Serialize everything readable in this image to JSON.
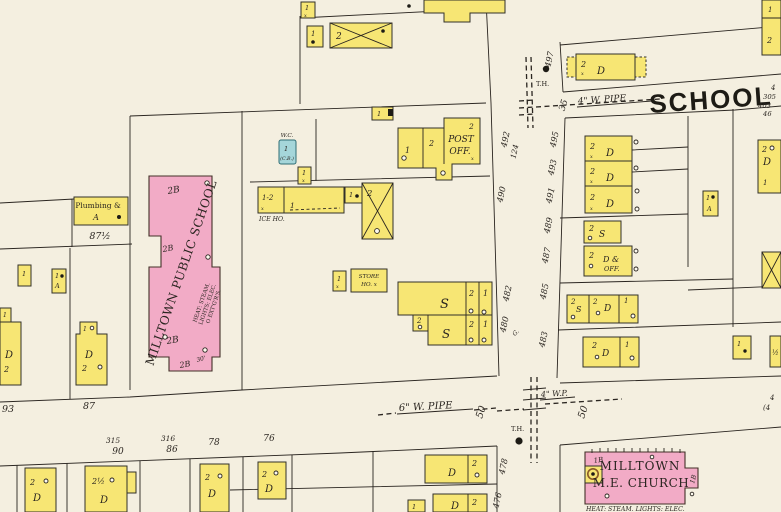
{
  "map": {
    "type": "sanborn-fire-insurance-map",
    "colors": {
      "background": "#f4efe0",
      "frame_building_yellow": "#f7e674",
      "brick_building_pink": "#f2abc6",
      "special_building_blue": "#a5d6da",
      "line_ink": "#2a2520"
    },
    "labels": {
      "plumbing1": "Plumbing &",
      "plumbing2": "A",
      "school_name": "MILLTOWN PUBLIC SCHOOL",
      "school_d1": "HEAT: STEAM.",
      "school_d2": "LIGHTS: ELEC.",
      "school_d3": "O EXT'G'R'S.",
      "wc": "W.C.",
      "cb": "(C.B.)",
      "ice": "ICE HO.",
      "store1": "STORE",
      "store2": "HO. x",
      "post1": "POST",
      "post2": "OFF.",
      "d_off1": "D &",
      "d_off2": "OFF.",
      "church1": "MILLTOWN",
      "church2": "M.E. CHURCH",
      "church_heat": "HEAT: STEAM. LIGHTS: ELEC.",
      "school_street": "SCHOOL",
      "pipe4": "4\" W. PIPE",
      "pipe6": "6\" W. PIPE",
      "pipe4b": "4\" W.P.",
      "th": "T.H."
    },
    "numbers": {
      "n497": "497",
      "n492": "492",
      "n124": "124",
      "n490": "490",
      "n482": "482",
      "n480": "480",
      "n478": "478",
      "n476": "476",
      "n495": "495",
      "n493": "493",
      "n491": "491",
      "n489": "489",
      "n487": "487",
      "n485": "485",
      "n483": "483",
      "n305": "305",
      "n403": "403",
      "n46": "46",
      "n4": "4",
      "n4p": "(4",
      "n93": "93",
      "n87": "87",
      "n315": "315",
      "n90": "90",
      "n316": "316",
      "n86": "86",
      "n78": "78",
      "n76": "76",
      "n35": "35",
      "n50": "50",
      "n87h": "87½",
      "g": "G."
    },
    "glyphs": {
      "one": "1",
      "two": "2",
      "d": "D",
      "s": "S",
      "a": "A",
      "x": "x",
      "half": "½",
      "two_half": "2½",
      "one_two": "1-2",
      "two_b": "2B",
      "one_b": "1B",
      "thirty": "30'"
    }
  }
}
